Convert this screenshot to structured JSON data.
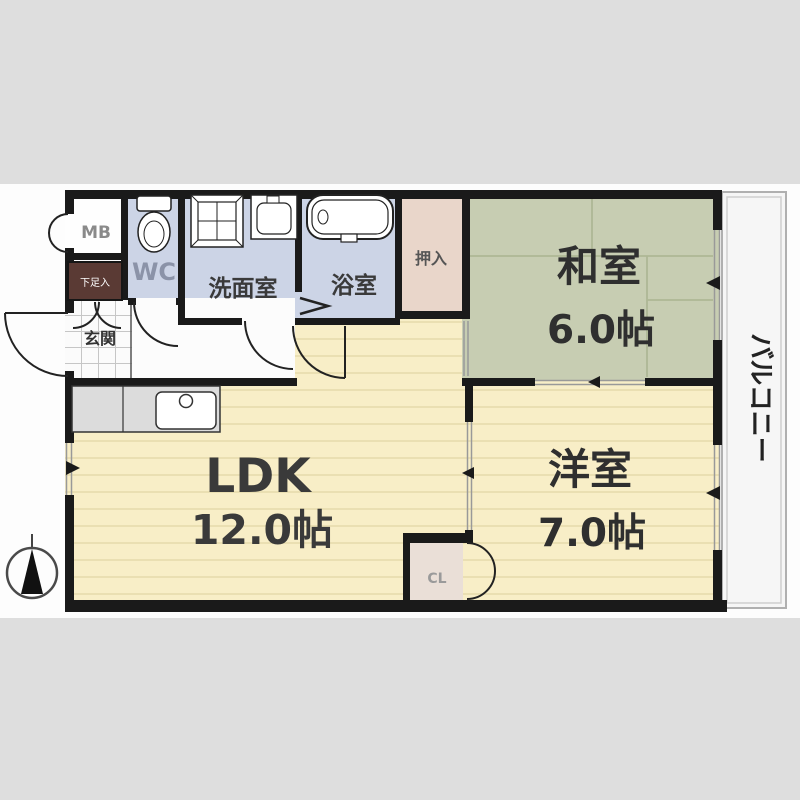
{
  "diagram_type": "Japanese apartment floor plan (2LDK)",
  "palette": {
    "canvas_bg": "#dedede",
    "paper_bg": "#fdfdfd",
    "wall": "#1a1a1a",
    "wet_area": "#ccd4e6",
    "tatami": "#c7cdb2",
    "tatami_line": "#aeb795",
    "flooring": "#f8eec7",
    "flooring_line": "#eadfb2",
    "closet_pink": "#e9d6ca",
    "cl_pink": "#eadfd7",
    "shoe_box_brown": "#5a3a34",
    "counter_gray": "#dcdcdc",
    "balcony_bg": "#f6f6f6",
    "label_dark": "#2f2f2f",
    "label_mid": "#3a3a3a",
    "label_gray": "#8a8a8a",
    "wc_label_gray": "#8b93a8",
    "cl_label_gray": "#9a9a9a",
    "white": "#ffffff"
  },
  "rooms": {
    "washitsu": {
      "label": "和室",
      "size": "6.0帖"
    },
    "yoshitsu": {
      "label": "洋室",
      "size": "7.0帖"
    },
    "ldk": {
      "label": "LDK",
      "size": "12.0帖"
    },
    "senmenshitsu": {
      "label": "洗面室"
    },
    "yokushitsu": {
      "label": "浴室"
    },
    "wc": {
      "label": "WC"
    },
    "meter_box": {
      "label": "MB"
    },
    "oshiire": {
      "label": "押入"
    },
    "genkan": {
      "label": "玄関"
    },
    "shoe_box": {
      "label": "下足入"
    },
    "closet": {
      "label": "CL"
    },
    "balcony": {
      "label": "バルコニー"
    }
  }
}
